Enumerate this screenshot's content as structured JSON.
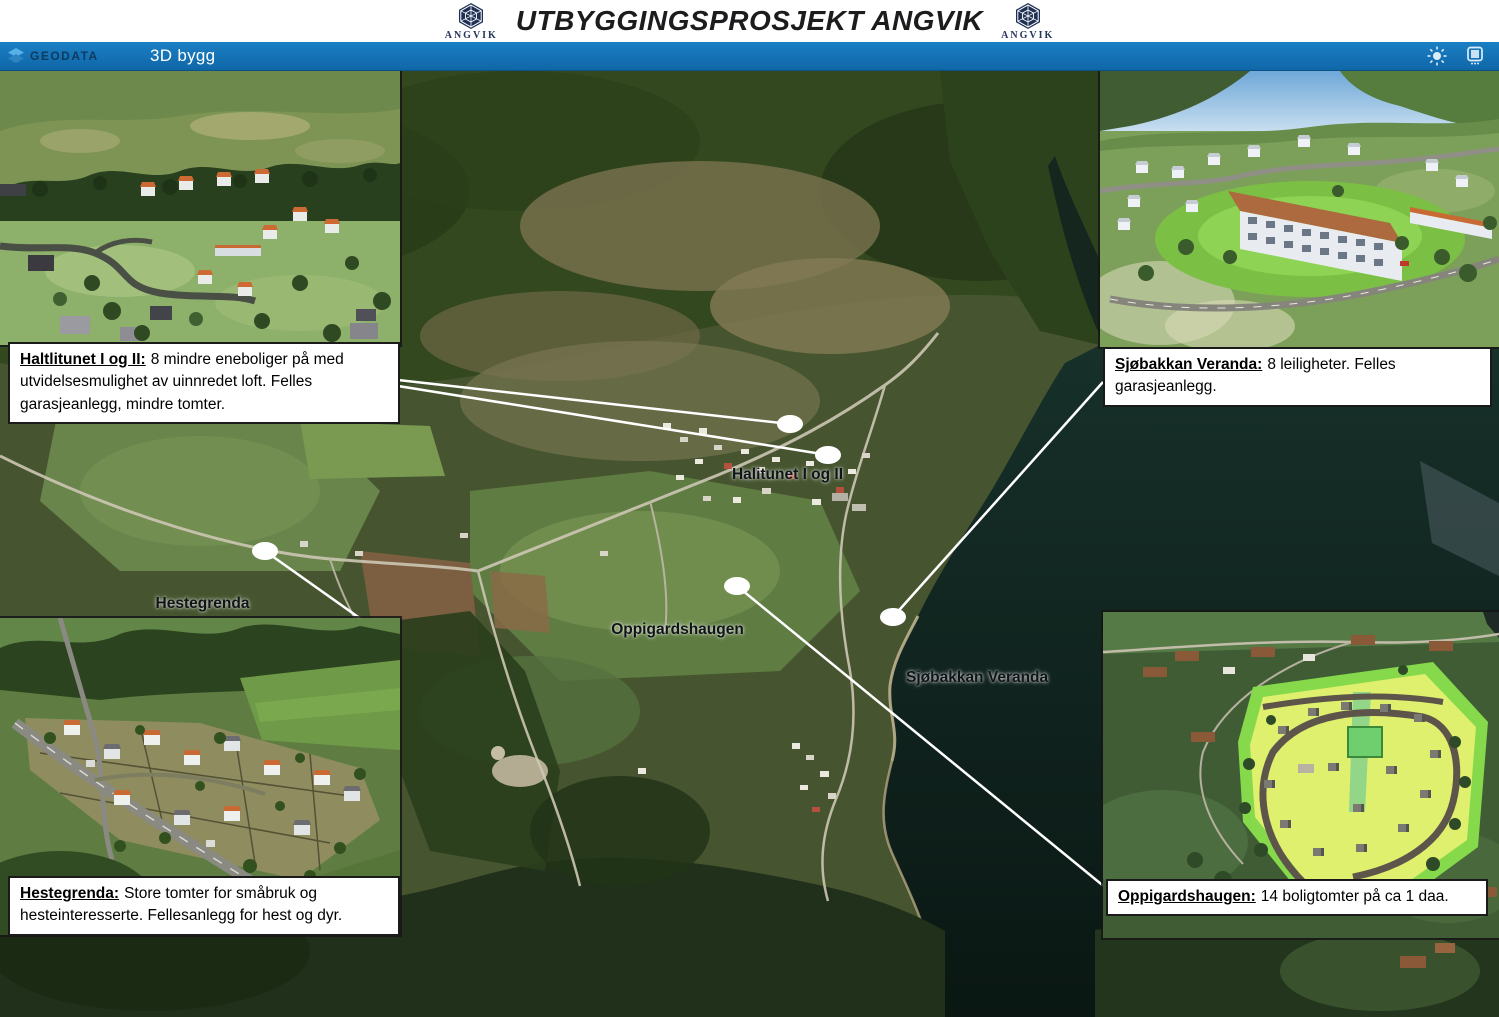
{
  "header": {
    "title": "UTBYGGINGSPROSJEKT ANGVIK",
    "logo_left_text": "ANGVIK",
    "logo_right_text": "ANGVIK"
  },
  "toolbar": {
    "brand": "GEODATA",
    "app_name": "3D bygg",
    "icons": [
      "sun-icon",
      "monitor-icon"
    ]
  },
  "map": {
    "labels": [
      "Halitunet I og II",
      "Hestegrenda",
      "Oppigardshaugen",
      "Sjøbakkan Veranda"
    ]
  },
  "insets": [
    {
      "name": "haltlitunet",
      "term": "Haltlitunet I og II:",
      "text": "8 mindre eneboliger på med utvidelsesmulighet av uinnredet loft. Felles garasjeanlegg, mindre tomter."
    },
    {
      "name": "sjobakkan-veranda",
      "term": "Sjøbakkan Veranda:",
      "text": "8 leiligheter. Felles garasjeanlegg."
    },
    {
      "name": "hestegrenda",
      "term": "Hestegrenda:",
      "text": "Store tomter for småbruk og hesteinteresserte. Fellesanlegg for hest og dyr."
    },
    {
      "name": "oppigardshaugen",
      "term": "Oppigardshaugen:",
      "text": "14 boligtomter på ca 1 daa."
    }
  ],
  "colors": {
    "toolbar_blue": "#1373b9",
    "logo_navy": "#26355e",
    "caption_border": "#1a1a1a",
    "connector_white": "#ffffff",
    "water_dark": "#101f1c"
  }
}
